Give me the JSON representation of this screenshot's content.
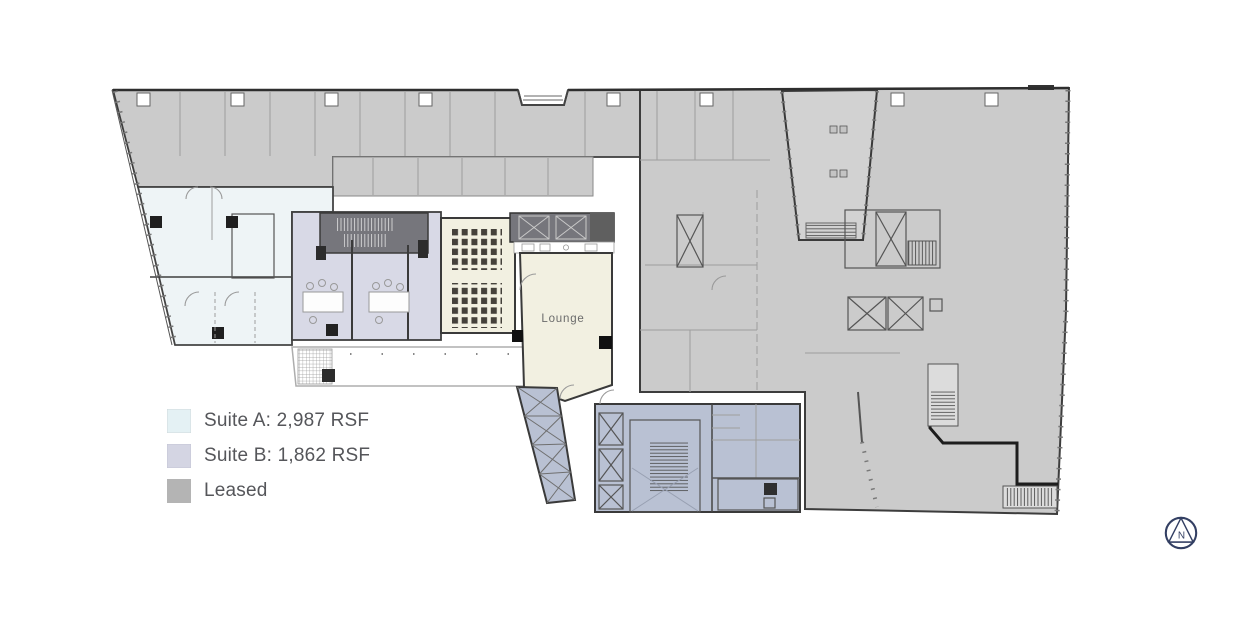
{
  "legend": {
    "items": [
      {
        "id": "suite-a",
        "label": "Suite A: 2,987 RSF",
        "color": "#e4f1f4"
      },
      {
        "id": "suite-b",
        "label": "Suite B: 1,862 RSF",
        "color": "#d4d5e3"
      },
      {
        "id": "leased",
        "label": "Leased",
        "color": "#b4b4b4"
      }
    ]
  },
  "plan": {
    "lounge_label": "Lounge"
  },
  "colors": {
    "leased_fill": "#cbcbcb",
    "atrium_fill": "#d2d2d2",
    "suite_a_fill": "#eef4f6",
    "suite_b_fill": "#d8d9e6",
    "lounge_fill": "#f2f0e1",
    "core_fill": "#b9c1d3",
    "dark_core_fill": "#76767c",
    "compass": "#333f63"
  },
  "compass": {
    "label": "N"
  }
}
